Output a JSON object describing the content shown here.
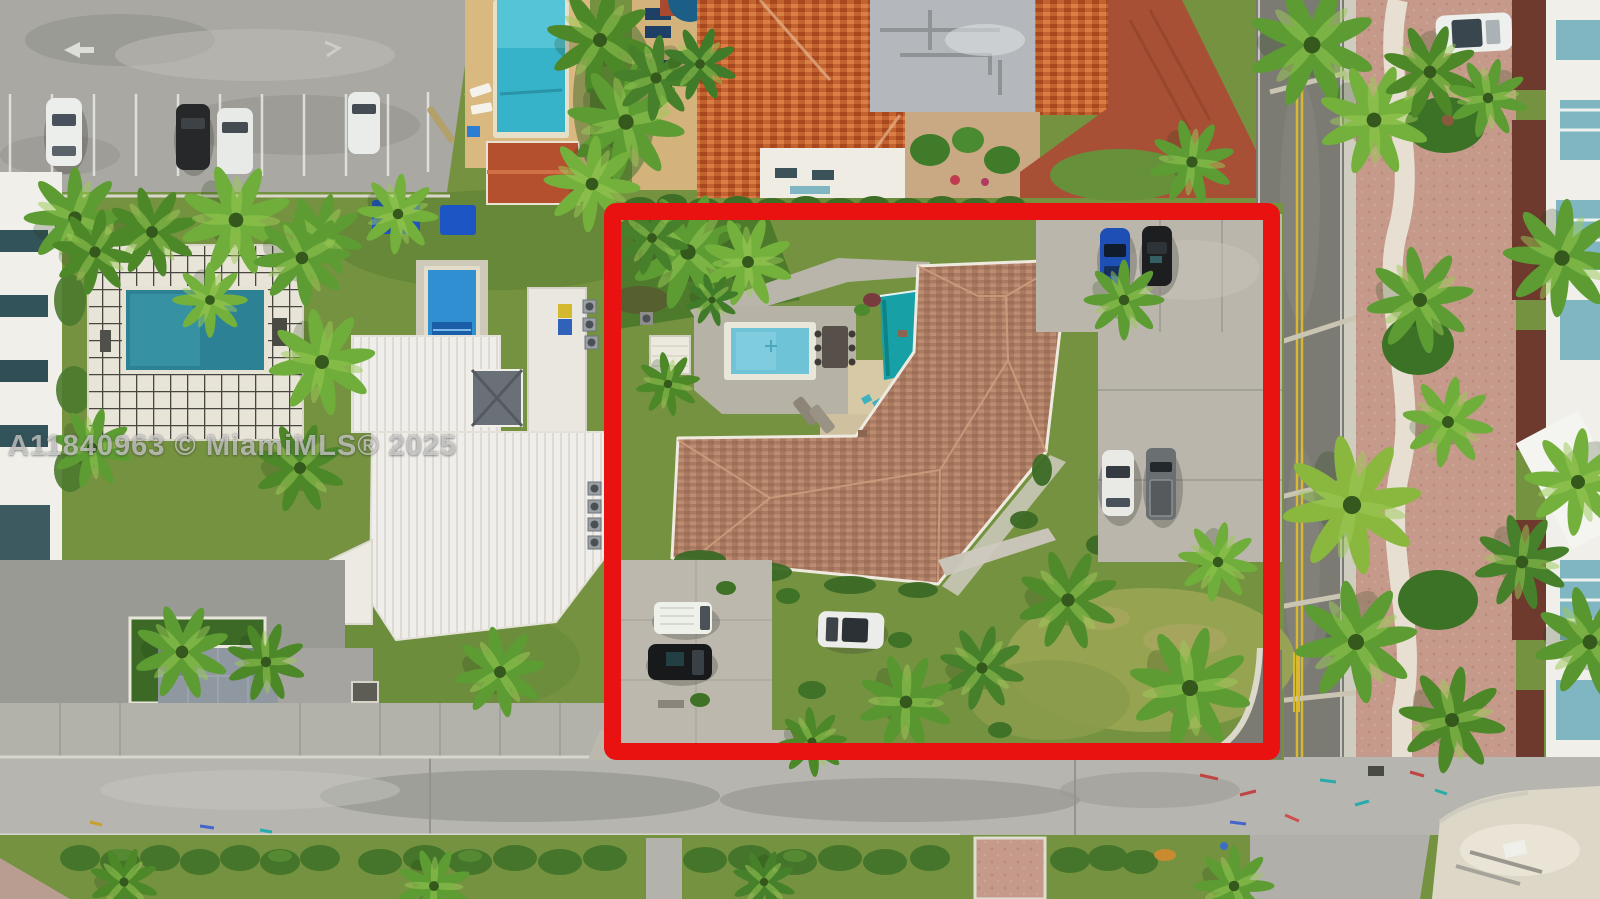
{
  "meta": {
    "type": "aerial-drone-photograph",
    "subject": "Overhead MLS listing photo of a single-family home parcel outlined in red, coastal residential neighborhood with palms, pools and streets",
    "width": 1600,
    "height": 899
  },
  "watermark": {
    "text": "A11840963 © MiamiMLS® 2025"
  },
  "colors": {
    "boundary_red": "#ea1111",
    "grass": "#74923f",
    "lawn_dry": "#9aa653",
    "asphalt_lot": "#a9a8a2",
    "street": "#7b7b73",
    "street_concrete": "#b6b5af",
    "concrete_drive": "#bab6ab",
    "deck_concrete": "#b7b2a6",
    "roof_subject": "#ab7a62",
    "roof_mansion": "#c2622e",
    "roof_cabana": "#b5502e",
    "flat_roof_gray": "#b4b8bc",
    "pool_left": "#2c8195",
    "pool_lap": "#37b3c9",
    "pool_subject": "#6ec3d6",
    "pool_house_blue": "#2f8fd0",
    "awning_teal": "#17a0a6",
    "awning_blue": "#1d55c4",
    "paver_pink": "#c59a8b",
    "paver_tan": "#d8c9a6",
    "sand": "#ddd7c7",
    "center_line_yellow": "#d8b82c",
    "palm_green": "#5d9c33",
    "hedge_green": "#44752a",
    "white_building": "#f0efe9",
    "glass_teal": "#7fb6c2",
    "brick_drive": "#a85036"
  },
  "scene": {
    "boundary": {
      "label": "red property outline",
      "x": 604,
      "y": 203,
      "width": 678,
      "height": 556
    },
    "subject_property": {
      "features": [
        "L-shaped tan tile-roof house",
        "rectangular pool with concrete deck",
        "teal awning",
        "outdoor dining table",
        "loungers",
        "concrete parking court",
        "sunny lawn with palms",
        "driveway to street"
      ],
      "vehicles": [
        "blue sedan",
        "black sedan",
        "white SUV",
        "gray pickup truck",
        "white van",
        "black car",
        "white car"
      ]
    },
    "surroundings": [
      "asphalt parking lot with four parked cars (top left)",
      "condo tower with teal pool on grid patio (left)",
      "white barrel-vault roof building (lower left)",
      "white house with pyramid skylight and small blue pool (center left)",
      "orange tile-roof mansion with flat gray section (top center)",
      "brick-red driveway (top right of mansion)",
      "palm-lined street with double yellow line (right)",
      "pink paver promenade with winding white path (far right)",
      "white car parked on promenade (top right)",
      "white buildings with teal glass (right edge)",
      "concrete street with utility paint markings (bottom)",
      "hedge strip and crosswalk pavers (bottom)",
      "sand pile at intersection corner (bottom right)"
    ]
  }
}
